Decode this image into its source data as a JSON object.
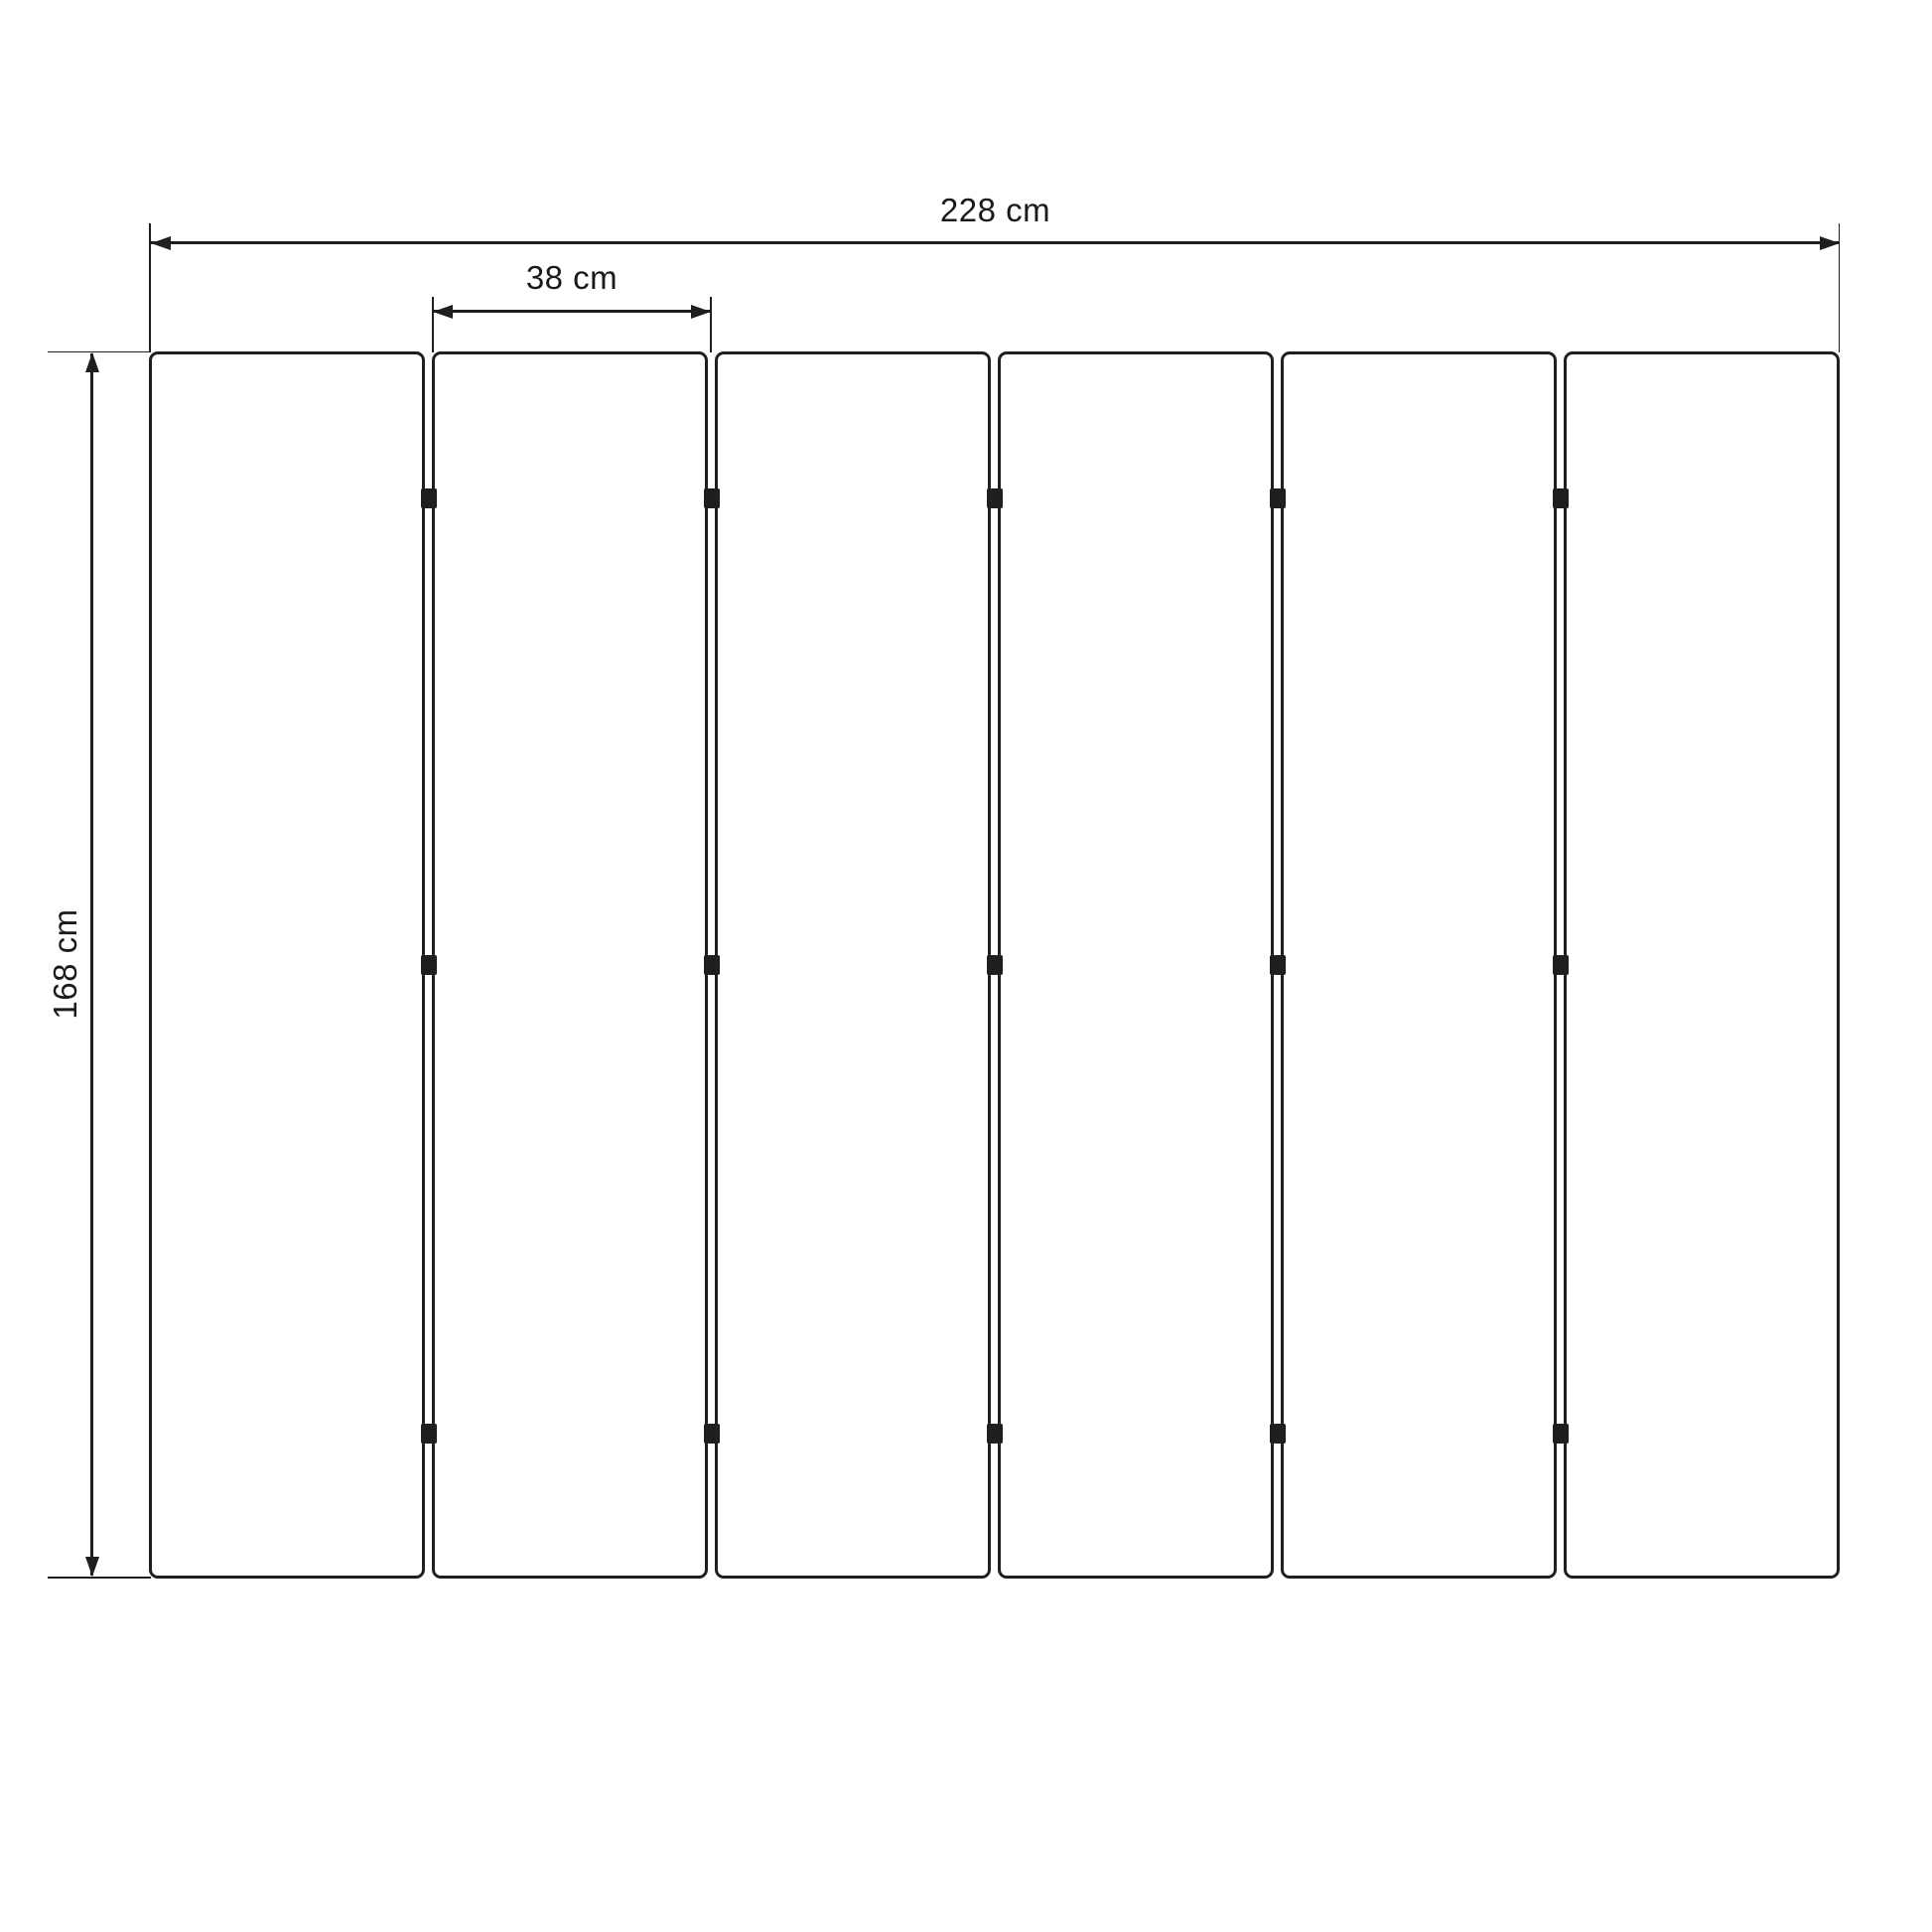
{
  "diagram": {
    "unit": "cm",
    "panel_count": 6,
    "hinge_rows_per_gap": 3,
    "dimensions": {
      "total_width": {
        "label": "228 cm",
        "value": 228,
        "orientation": "horizontal"
      },
      "panel_width": {
        "label": "38 cm",
        "value": 38,
        "orientation": "horizontal"
      },
      "height": {
        "label": "168 cm",
        "value": 168,
        "orientation": "vertical"
      }
    },
    "colors": {
      "line": "#1f1f1f",
      "text": "#1a1a1a",
      "background": "#ffffff",
      "panel_fill": "#ffffff"
    }
  }
}
